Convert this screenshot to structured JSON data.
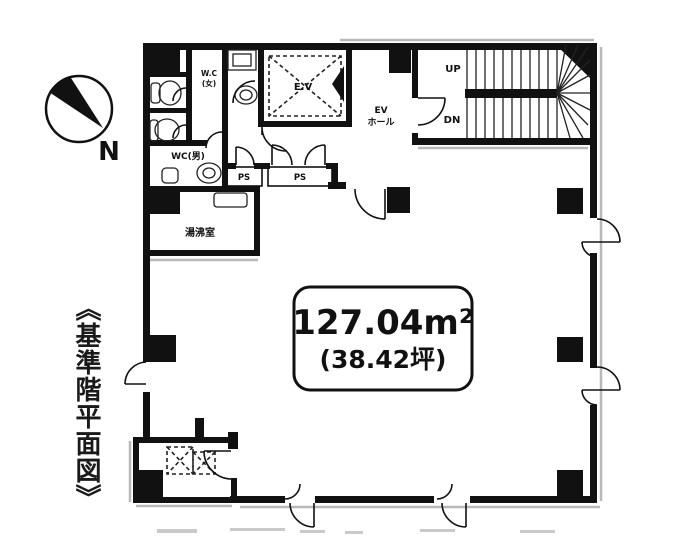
{
  "title": {
    "text": "《基準階平面図》"
  },
  "compass": {
    "north_label": "N"
  },
  "area_label": {
    "m2": "127.04m²",
    "tsubo": "(38.42坪)"
  },
  "rooms": {
    "wc_women_l1": "W.C",
    "wc_women_l2": "(女)",
    "wc_men": "WC(男)",
    "kitchenette": "湯沸室",
    "ps1": "PS",
    "ps2": "PS",
    "ev_shaft": "E.V",
    "ev_hall_l1": "EV",
    "ev_hall_l2": "ホール"
  },
  "stairs": {
    "up": "UP",
    "down": "DN"
  },
  "colors": {
    "wall": "#111111",
    "shadow": "#b8b8b8",
    "background": "#ffffff"
  }
}
